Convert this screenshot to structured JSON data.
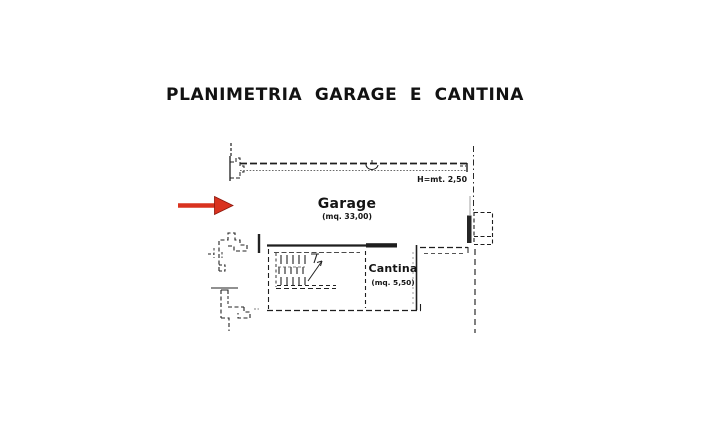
{
  "title": "PLANIMETRIA GARAGE E CANTINA",
  "plan": {
    "garage": {
      "name": "Garage",
      "area": "(mq. 33,00)"
    },
    "cantina": {
      "name": "Cantina",
      "area": "(mq. 5,50)"
    },
    "height_note": "H=mt. 2,50",
    "colors": {
      "line": "#1e1e1e",
      "secondary_line": "#555555",
      "arrow": "#d9321f",
      "arrow_edge": "#8a170c"
    }
  }
}
